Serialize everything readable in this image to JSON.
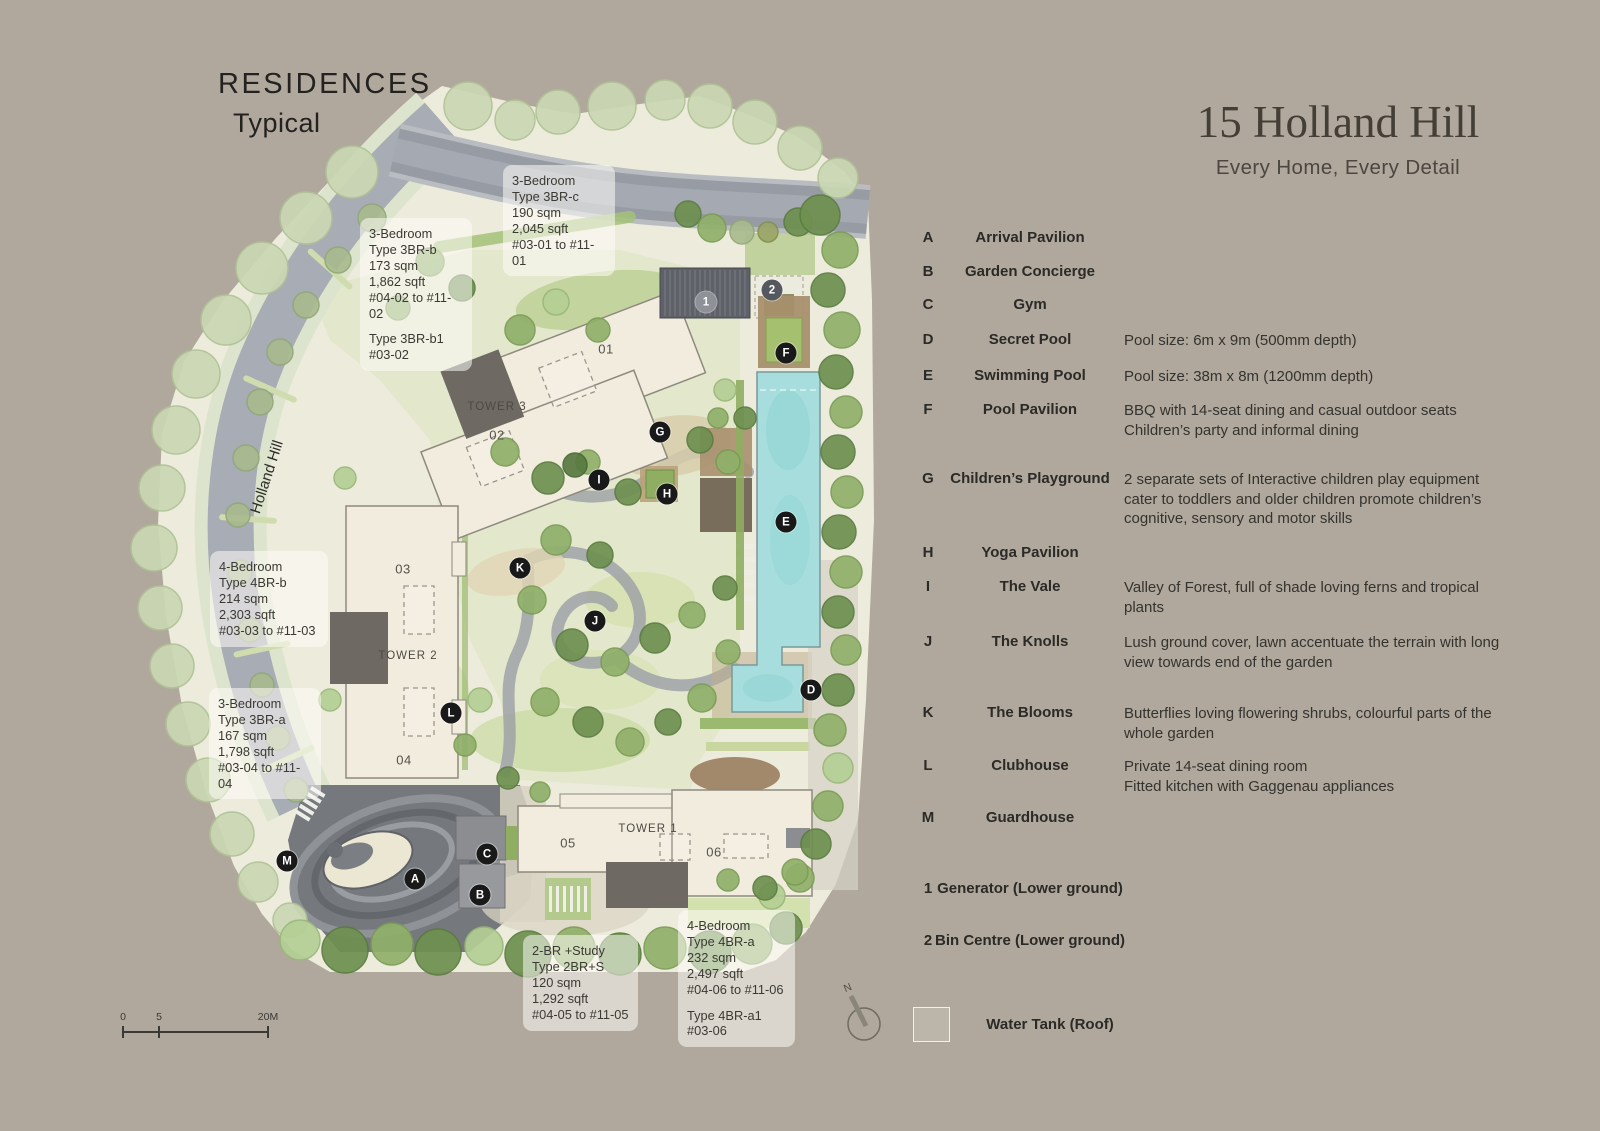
{
  "header": {
    "title": "RESIDENCES",
    "subtitle": "Typical"
  },
  "brand": {
    "name": "15 Holland Hill",
    "tagline": "Every Home, Every Detail"
  },
  "legend": {
    "items": [
      {
        "key": "A",
        "name": "Arrival Pavilion",
        "desc": []
      },
      {
        "key": "B",
        "name": "Garden Concierge",
        "desc": []
      },
      {
        "key": "C",
        "name": "Gym",
        "desc": []
      },
      {
        "key": "D",
        "name": "Secret Pool",
        "desc": [
          "Pool size: 6m x 9m (500mm depth)"
        ]
      },
      {
        "key": "E",
        "name": "Swimming Pool",
        "desc": [
          "Pool size: 38m x 8m (1200mm depth)"
        ]
      },
      {
        "key": "F",
        "name": "Pool Pavilion",
        "desc": [
          "BBQ with 14-seat dining and casual outdoor seats",
          "Children’s party and informal dining"
        ]
      },
      {
        "key": "G",
        "name": "Children’s Playground",
        "desc": [
          "2 separate sets of Interactive children play equipment",
          "cater to toddlers and older children promote children’s",
          "cognitive, sensory and motor skills"
        ]
      },
      {
        "key": "H",
        "name": "Yoga Pavilion",
        "desc": []
      },
      {
        "key": "I",
        "name": "The Vale",
        "desc": [
          "Valley of Forest, full of shade loving ferns and tropical",
          "plants"
        ]
      },
      {
        "key": "J",
        "name": "The Knolls",
        "desc": [
          "Lush ground cover, lawn accentuate the terrain with long",
          "view towards end of the garden"
        ]
      },
      {
        "key": "K",
        "name": "The Blooms",
        "desc": [
          "Butterflies loving flowering shrubs, colourful parts of the",
          "whole garden"
        ]
      },
      {
        "key": "L",
        "name": "Clubhouse",
        "desc": [
          "Private 14-seat dining room",
          "Fitted kitchen with Gaggenau appliances"
        ]
      },
      {
        "key": "M",
        "name": "Guardhouse",
        "desc": []
      }
    ],
    "numbered": [
      {
        "key": "1",
        "name": "Generator (Lower ground)"
      },
      {
        "key": "2",
        "name": "Bin Centre (Lower ground)"
      }
    ],
    "water_tank_label": "Water Tank (Roof)"
  },
  "map": {
    "road_label": "Holland Hill",
    "compass_label": "N",
    "towers": [
      {
        "label": "TOWER 3",
        "label_x": 497,
        "label_y": 407,
        "units": [
          {
            "no": "01",
            "x": 606,
            "y": 349
          },
          {
            "no": "02",
            "x": 497,
            "y": 435
          }
        ]
      },
      {
        "label": "TOWER 2",
        "label_x": 408,
        "label_y": 656,
        "units": [
          {
            "no": "03",
            "x": 403,
            "y": 569
          },
          {
            "no": "04",
            "x": 404,
            "y": 760
          }
        ]
      },
      {
        "label": "TOWER 1",
        "label_x": 648,
        "label_y": 829,
        "units": [
          {
            "no": "05",
            "x": 568,
            "y": 843
          },
          {
            "no": "06",
            "x": 714,
            "y": 852
          }
        ]
      }
    ],
    "markers": [
      {
        "letter": "A",
        "x": 415,
        "y": 879,
        "variant": "black"
      },
      {
        "letter": "B",
        "x": 480,
        "y": 895,
        "variant": "black"
      },
      {
        "letter": "C",
        "x": 487,
        "y": 854,
        "variant": "black"
      },
      {
        "letter": "D",
        "x": 811,
        "y": 690,
        "variant": "black"
      },
      {
        "letter": "E",
        "x": 786,
        "y": 522,
        "variant": "black"
      },
      {
        "letter": "F",
        "x": 786,
        "y": 353,
        "variant": "black"
      },
      {
        "letter": "G",
        "x": 660,
        "y": 432,
        "variant": "black"
      },
      {
        "letter": "H",
        "x": 667,
        "y": 494,
        "variant": "black"
      },
      {
        "letter": "I",
        "x": 599,
        "y": 480,
        "variant": "black"
      },
      {
        "letter": "J",
        "x": 595,
        "y": 621,
        "variant": "black"
      },
      {
        "letter": "K",
        "x": 520,
        "y": 568,
        "variant": "black"
      },
      {
        "letter": "L",
        "x": 451,
        "y": 713,
        "variant": "black"
      },
      {
        "letter": "M",
        "x": 287,
        "y": 861,
        "variant": "black"
      },
      {
        "letter": "1",
        "x": 706,
        "y": 302,
        "variant": "gray1"
      },
      {
        "letter": "2",
        "x": 772,
        "y": 290,
        "variant": "gray2"
      }
    ],
    "callouts": [
      {
        "x": 503,
        "y": 165,
        "w": 112,
        "lines": [
          "3-Bedroom",
          "Type 3BR-c",
          "190 sqm",
          "2,045 sqft",
          "#03-01 to #11-01"
        ]
      },
      {
        "x": 360,
        "y": 218,
        "w": 112,
        "lines": [
          "3-Bedroom",
          "Type 3BR-b",
          "173 sqm",
          "1,862 sqft",
          "#04-02 to #11-02",
          "",
          "Type 3BR-b1",
          "#03-02"
        ]
      },
      {
        "x": 210,
        "y": 551,
        "w": 118,
        "lines": [
          "4-Bedroom",
          "Type 4BR-b",
          "214 sqm",
          "2,303 sqft",
          "#03-03 to #11-03"
        ]
      },
      {
        "x": 209,
        "y": 688,
        "w": 112,
        "lines": [
          "3-Bedroom",
          "Type 3BR-a",
          "167 sqm",
          "1,798 sqft",
          "#03-04 to #11-04"
        ]
      },
      {
        "x": 523,
        "y": 935,
        "w": 115,
        "lines": [
          "2-BR +Study",
          "Type 2BR+S",
          "120 sqm",
          "1,292 sqft",
          "#04-05 to #11-05"
        ]
      },
      {
        "x": 678,
        "y": 910,
        "w": 117,
        "lines": [
          "4-Bedroom",
          "Type 4BR-a",
          "232 sqm",
          "2,497 sqft",
          "#04-06 to #11-06",
          "",
          "Type 4BR-a1",
          "#03-06"
        ]
      }
    ],
    "scale": {
      "t0": "0",
      "t1": "5",
      "t2": "20M"
    }
  }
}
